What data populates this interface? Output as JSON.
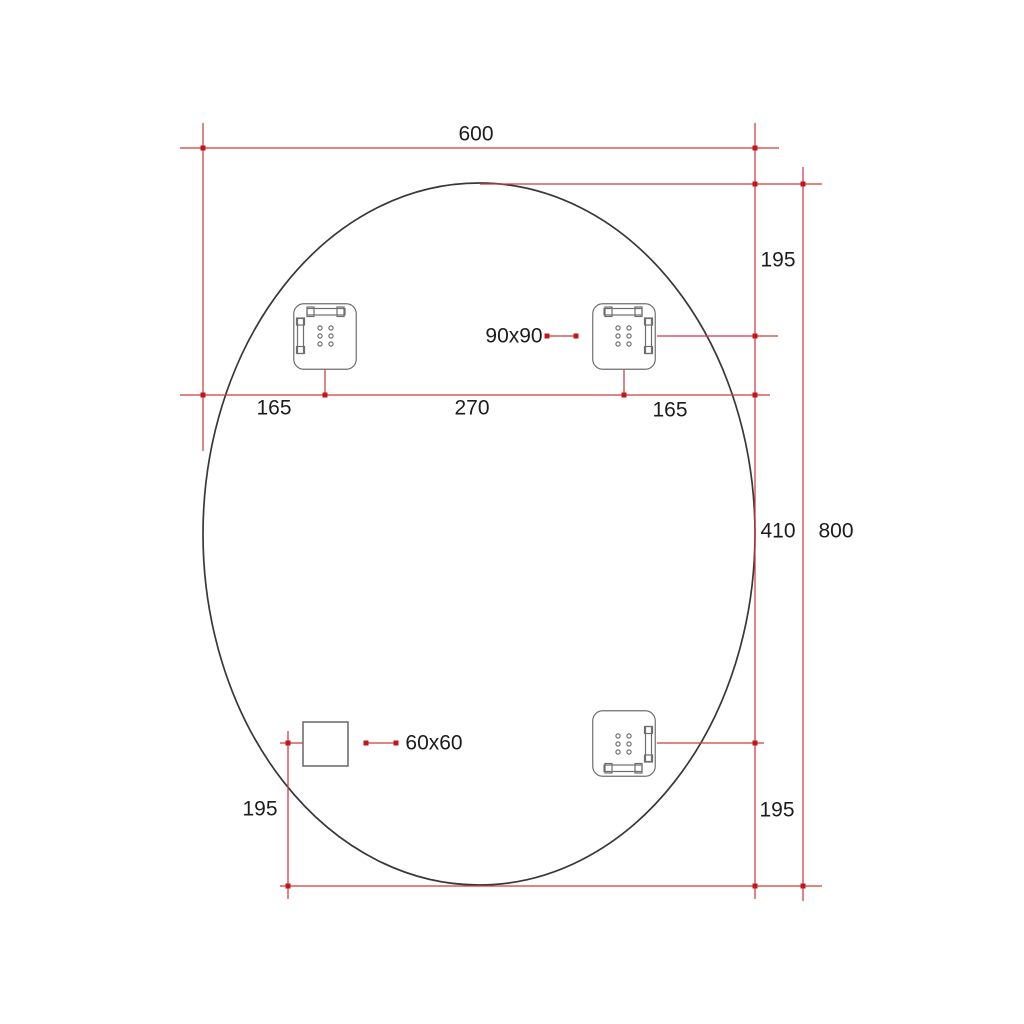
{
  "drawing": {
    "type": "oval-mirror-technical-drawing",
    "dimensions": {
      "overall_width": "600",
      "overall_height": "800",
      "top_right_offset": "195",
      "center_to_bottom_right": "410",
      "left_edge_to_bracket": "165",
      "between_brackets": "270",
      "bracket_to_right_edge": "165",
      "bracket_size": "90x90",
      "square_size": "60x60",
      "bottom_left_offset": "195",
      "bottom_right_offset": "195"
    },
    "colors": {
      "dimension_red": "#ce3b3e",
      "dot_red": "#c3161b",
      "outline_dark": "#383838",
      "plate_gray": "#6f6f6f",
      "text_dark": "#1c1c1c",
      "background": "#ffffff"
    }
  }
}
